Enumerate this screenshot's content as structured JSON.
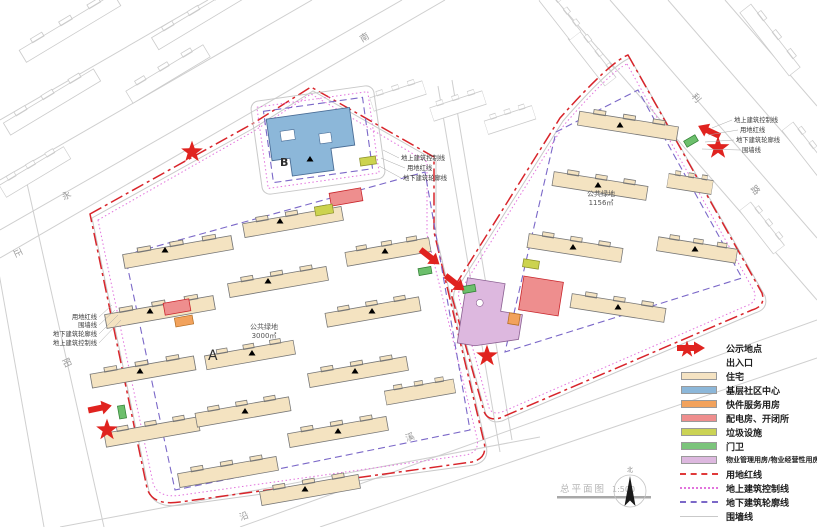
{
  "drawing": {
    "plan_title": "总平面图",
    "plan_scale": "1:500",
    "parcel_a_label": "A",
    "parcel_b_label": "B",
    "green_space_a": {
      "name": "公共绿地",
      "area": "3000㎡"
    },
    "green_space_right": {
      "name": "公共绿地",
      "area": "1156㎡"
    },
    "north_label": "北"
  },
  "roads": {
    "south": "南",
    "yong": "永",
    "zheng": "正",
    "yang": "阳",
    "li": "利",
    "lu": "路",
    "yan": "沿",
    "xi": "溪"
  },
  "annotations": {
    "left": {
      "l1": "用地红线",
      "l2": "围墙线",
      "l3": "地下建筑轮廓线",
      "l4": "地上建筑控制线"
    },
    "center": {
      "l1": "地上建筑控制线",
      "l2": "用地红线",
      "l3": "地下建筑轮廓线"
    },
    "right": {
      "l1": "地上建筑控制线",
      "l2": "用地红线",
      "l3": "地下建筑轮廓线",
      "l4": "围墙线"
    }
  },
  "legend": {
    "items": [
      {
        "label": "公示地点",
        "symbol": "star",
        "color": "#e0231f"
      },
      {
        "label": "出入口",
        "symbol": "arrow",
        "color": "#e0231f"
      },
      {
        "label": "住宅",
        "symbol": "swatch",
        "color": "#f5e3c2"
      },
      {
        "label": "基层社区中心",
        "symbol": "swatch",
        "color": "#8cb7d9"
      },
      {
        "label": "快件服务用房",
        "symbol": "swatch",
        "color": "#f2a25c"
      },
      {
        "label": "配电房、开闭所",
        "symbol": "swatch",
        "color": "#ef8e8e"
      },
      {
        "label": "垃圾设施",
        "symbol": "swatch",
        "color": "#cbd355"
      },
      {
        "label": "门卫",
        "symbol": "swatch",
        "color": "#7bc47b"
      },
      {
        "label": "物业管理用房/物业经营性用房",
        "symbol": "swatch",
        "color": "#ddb8df"
      },
      {
        "label": "用地红线",
        "symbol": "line-red-dashdot",
        "color": "#e03a3a"
      },
      {
        "label": "地上建筑控制线",
        "symbol": "line-magenta-dot",
        "color": "#e273dd"
      },
      {
        "label": "地下建筑轮廓线",
        "symbol": "line-violet-dash",
        "color": "#7b68c8"
      },
      {
        "label": "围墙线",
        "symbol": "line-gray",
        "color": "#c9c9c9"
      }
    ]
  }
}
